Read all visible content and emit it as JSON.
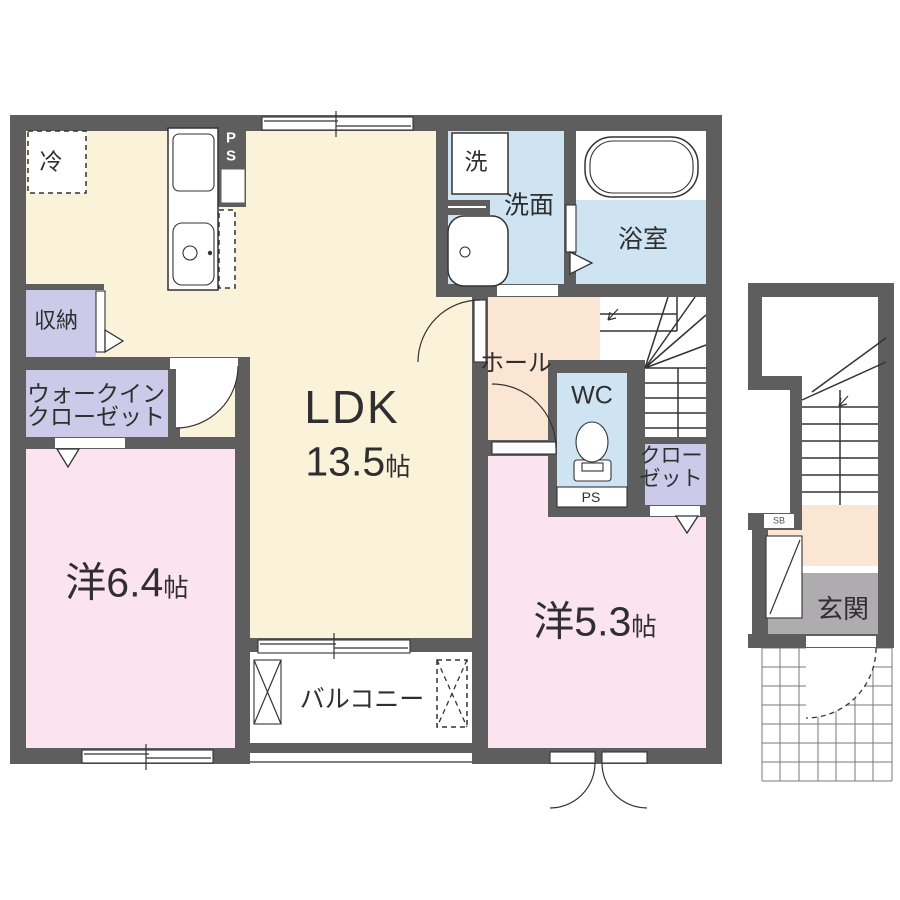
{
  "floorplan": {
    "rooms": {
      "ldk": {
        "name": "LDK",
        "size": "13.5",
        "unit": "帖"
      },
      "western_6_4": {
        "name": "洋6.4",
        "unit": "帖"
      },
      "western_5_3": {
        "name": "洋5.3",
        "unit": "帖"
      },
      "walk_in_closet": {
        "line1": "ウォークイン",
        "line2": "クローゼット"
      },
      "storage": {
        "label": "収納"
      },
      "closet": {
        "line1": "クロー",
        "line2": "ゼット"
      },
      "washroom": {
        "label": "洗面"
      },
      "washer": {
        "label": "洗"
      },
      "bathroom": {
        "label": "浴室"
      },
      "hall": {
        "label": "ホール"
      },
      "wc": {
        "label": "WC"
      },
      "balcony": {
        "label": "バルコニー"
      },
      "entrance": {
        "label": "玄関"
      },
      "refrigerator": {
        "label": "冷"
      },
      "pipe_shaft_kitchen": {
        "p": "P",
        "s": "S"
      },
      "pipe_shaft_wc": {
        "label": "PS"
      },
      "shoe_box": {
        "label": "SB"
      }
    },
    "colors": {
      "wall": "#5e5e5e",
      "ldk_floor": "#faf3da",
      "bedroom_floor": "#fbe4ef",
      "closet_floor": "#cbcbe9",
      "wet_area_floor": "#cee4f2",
      "hall_floor": "#fbe5d3",
      "entrance_floor": "#aeacae",
      "line": "#333333",
      "background": "#ffffff"
    }
  }
}
